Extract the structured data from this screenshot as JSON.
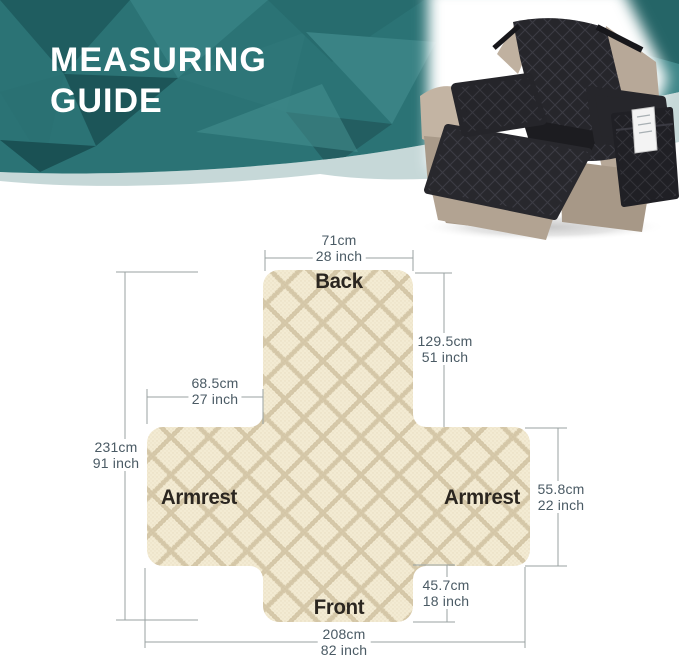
{
  "header": {
    "title": "MEASURING GUIDE"
  },
  "diagram": {
    "labels": {
      "back": "Back",
      "armrest_left": "Armrest",
      "armrest_right": "Armrest",
      "front": "Front"
    },
    "measurements": {
      "back_width": {
        "cm": "71cm",
        "inch": "28 inch"
      },
      "back_height": {
        "cm": "129.5cm",
        "inch": "51 inch"
      },
      "armrest_length": {
        "cm": "68.5cm",
        "inch": "27 inch"
      },
      "total_length": {
        "cm": "231cm",
        "inch": "91 inch"
      },
      "armrest_height": {
        "cm": "55.8cm",
        "inch": "22 inch"
      },
      "front_height": {
        "cm": "45.7cm",
        "inch": "18 inch"
      },
      "total_width": {
        "cm": "208cm",
        "inch": "82 inch"
      }
    }
  },
  "colors": {
    "banner_teal": "#2b7375",
    "accent_band": "#c6d8d8",
    "fabric_cream": "#f3ebd3",
    "cover_black": "#26262b",
    "chair_taupe": "#b7a898",
    "dimension_line": "#98a2a2",
    "measure_text": "#4a5a64",
    "label_text": "#2b2620"
  }
}
